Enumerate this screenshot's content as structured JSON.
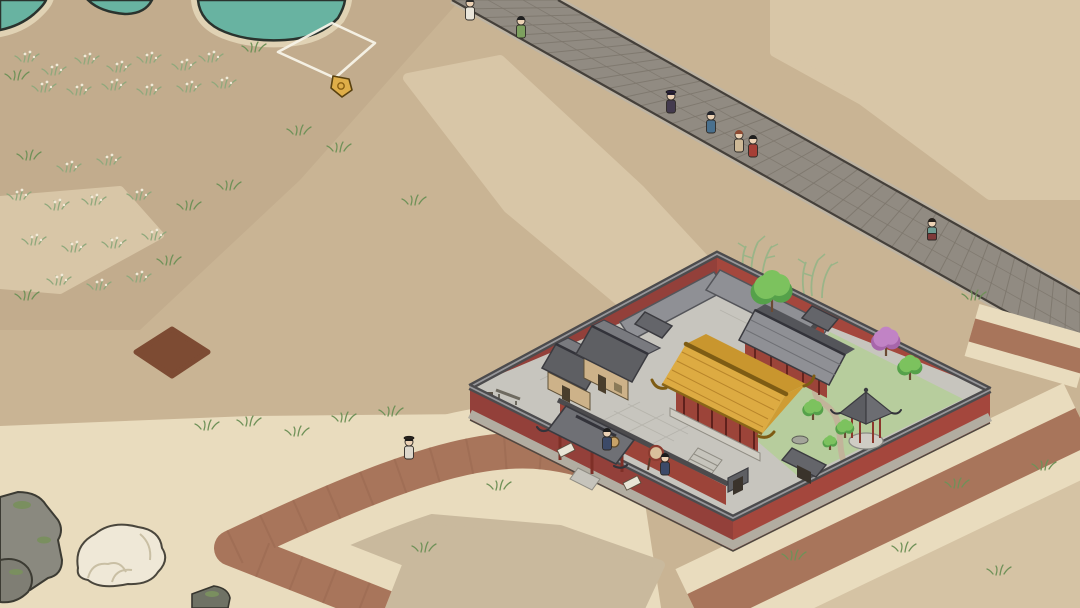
{
  "game": {
    "view": "isometric-town-overworld",
    "selection_tile": {
      "shape": "diamond-outline",
      "corners": [
        [
          332,
          23
        ],
        [
          375,
          43
        ],
        [
          335,
          78
        ],
        [
          278,
          52
        ]
      ],
      "marker": {
        "name": "gold-tag-marker",
        "x": 341,
        "y": 86
      }
    },
    "compound": {
      "type": "walled-temple-courtyard",
      "features": [
        "red-perimeter-wall",
        "golden-main-hall",
        "wooden-houses",
        "entrance-gate",
        "drum",
        "garden",
        "gazebo",
        "winding-path",
        "inner-gates"
      ]
    }
  },
  "palette": {
    "sand_base": "#c9b494",
    "sand_dark": "#c2ac8d",
    "sand_light": "#d8c6a7",
    "sand_cream": "#e9dcbe",
    "sand_gray": "#c9b99d",
    "soil_dark": "#7d4b33",
    "pond_teal": "#68b3a1",
    "pond_outline": "#2a332e",
    "shore": "#e0d2b4",
    "road_fill": "#918b82",
    "road_edge_dark": "#45403a",
    "road_curb": "#beb4a3",
    "road_slat": "#7d766c",
    "dirt_path": "#a8755b",
    "wall_red": "#9c4439",
    "wall_red_light": "#a4473d",
    "wall_red_dark": "#93403a",
    "coping": "#4c4b4d",
    "coping_light": "#97979a",
    "plinth": "#b2ada1",
    "paving": "#c7c5be",
    "paving_line": "#b0aea6",
    "roof_gray": "#64656a",
    "roof_gray_light": "#8f9095",
    "roof_gray_dark": "#54555a",
    "roof_gold": "#ddab42",
    "roof_gold_back": "#c9962e",
    "roof_gold_line": "#b8852a",
    "gold_trim": "#7e5c14",
    "wood_wall": "#cdb289",
    "wood_dark": "#5f5138",
    "lawn": "#b7cd9d",
    "garden_path": "#c2b49a",
    "tree_green": "#7cc25e",
    "tree_green_dark": "#55a14a",
    "tree_pink": "#c183c5",
    "tree_pink_dark": "#a766ab",
    "bamboo": "#9ab488",
    "skin": "#ecd2b5",
    "marker_gold": "#dfae49",
    "selection_white": "#f7f3e8",
    "rock_gray": "#8a897f",
    "rock_white": "#efe8d7",
    "moss": "#7a8f5f"
  },
  "scene": {
    "people": [
      {
        "id": "walker-white-top",
        "x": 470,
        "y": 20,
        "robe": "#e9e5da",
        "hair": "#2b2b2b"
      },
      {
        "id": "walker-green",
        "x": 521,
        "y": 38,
        "robe": "#7da05e",
        "hair": "#1f1f1f"
      },
      {
        "id": "walker-dark-purple",
        "x": 671,
        "y": 113,
        "robe": "#433a4e",
        "hair": "#27203a",
        "hat": "#27203a"
      },
      {
        "id": "walker-blue",
        "x": 711,
        "y": 133,
        "robe": "#49708e",
        "hair": "#22242c"
      },
      {
        "id": "walker-beige",
        "x": 739,
        "y": 152,
        "robe": "#cdb896",
        "hair": "#8e4b33"
      },
      {
        "id": "walker-red",
        "x": 753,
        "y": 157,
        "robe": "#a63f36",
        "hair": "#1f1f1f"
      },
      {
        "id": "walker-teal-skirt",
        "x": 932,
        "y": 240,
        "robe": "#6e9c93",
        "skirt": "#7e3a3a",
        "hair": "#27211c"
      },
      {
        "id": "traveler-path",
        "x": 409,
        "y": 459,
        "robe": "#ddd7cb",
        "hair": "#1c1c1c",
        "hat": "#26221e"
      },
      {
        "id": "guard-gate",
        "x": 607,
        "y": 450,
        "robe": "#3c4a68",
        "hair": "#1c1c1c"
      },
      {
        "id": "guard-drum",
        "x": 665,
        "y": 475,
        "robe": "#3c4a68",
        "hair": "#1c1c1c"
      }
    ],
    "trees": [
      {
        "id": "courtyard-tree",
        "type": "green",
        "x": 772,
        "y": 312,
        "r": 20
      },
      {
        "id": "garden-pink-tree",
        "type": "pink",
        "x": 886,
        "y": 356,
        "r": 14
      },
      {
        "id": "garden-tree-1",
        "type": "green",
        "x": 910,
        "y": 380,
        "r": 12
      },
      {
        "id": "garden-tree-2",
        "type": "green",
        "x": 813,
        "y": 420,
        "r": 10
      },
      {
        "id": "garden-tree-3",
        "type": "green",
        "x": 845,
        "y": 438,
        "r": 9
      },
      {
        "id": "garden-tree-4",
        "type": "green",
        "x": 830,
        "y": 450,
        "r": 7
      }
    ],
    "grass": [
      {
        "x": 28,
        "y": 62,
        "v": "flower"
      },
      {
        "x": 55,
        "y": 75,
        "v": "flower"
      },
      {
        "x": 88,
        "y": 64,
        "v": "flower"
      },
      {
        "x": 120,
        "y": 72,
        "v": "flower"
      },
      {
        "x": 150,
        "y": 63,
        "v": "flower"
      },
      {
        "x": 185,
        "y": 70,
        "v": "flower"
      },
      {
        "x": 212,
        "y": 62,
        "v": "flower"
      },
      {
        "x": 45,
        "y": 92,
        "v": "flower"
      },
      {
        "x": 80,
        "y": 95,
        "v": "flower"
      },
      {
        "x": 115,
        "y": 90,
        "v": "flower"
      },
      {
        "x": 150,
        "y": 95,
        "v": "flower"
      },
      {
        "x": 190,
        "y": 92,
        "v": "flower"
      },
      {
        "x": 225,
        "y": 88,
        "v": "flower"
      },
      {
        "x": 18,
        "y": 80,
        "v": "sprig"
      },
      {
        "x": 255,
        "y": 52,
        "v": "sprig"
      },
      {
        "x": 30,
        "y": 160,
        "v": "sprig"
      },
      {
        "x": 70,
        "y": 172,
        "v": "flower"
      },
      {
        "x": 110,
        "y": 165,
        "v": "flower"
      },
      {
        "x": 20,
        "y": 200,
        "v": "flower"
      },
      {
        "x": 58,
        "y": 210,
        "v": "flower"
      },
      {
        "x": 95,
        "y": 205,
        "v": "flower"
      },
      {
        "x": 140,
        "y": 200,
        "v": "flower"
      },
      {
        "x": 35,
        "y": 245,
        "v": "flower"
      },
      {
        "x": 75,
        "y": 252,
        "v": "flower"
      },
      {
        "x": 115,
        "y": 248,
        "v": "flower"
      },
      {
        "x": 155,
        "y": 240,
        "v": "flower"
      },
      {
        "x": 60,
        "y": 285,
        "v": "flower"
      },
      {
        "x": 100,
        "y": 290,
        "v": "flower"
      },
      {
        "x": 140,
        "y": 282,
        "v": "flower"
      },
      {
        "x": 28,
        "y": 300,
        "v": "sprig"
      },
      {
        "x": 170,
        "y": 265,
        "v": "sprig"
      },
      {
        "x": 190,
        "y": 210,
        "v": "sprig"
      },
      {
        "x": 230,
        "y": 190,
        "v": "sprig"
      },
      {
        "x": 300,
        "y": 135,
        "v": "sprig"
      },
      {
        "x": 340,
        "y": 152,
        "v": "sprig"
      },
      {
        "x": 415,
        "y": 205,
        "v": "sprig"
      },
      {
        "x": 208,
        "y": 430,
        "v": "sprig"
      },
      {
        "x": 250,
        "y": 426,
        "v": "sprig"
      },
      {
        "x": 298,
        "y": 436,
        "v": "sprig"
      },
      {
        "x": 345,
        "y": 422,
        "v": "sprig"
      },
      {
        "x": 392,
        "y": 416,
        "v": "sprig"
      },
      {
        "x": 500,
        "y": 490,
        "v": "sprig"
      },
      {
        "x": 425,
        "y": 552,
        "v": "sprig"
      },
      {
        "x": 612,
        "y": 470,
        "v": "sprig"
      },
      {
        "x": 660,
        "y": 492,
        "v": "sprig"
      },
      {
        "x": 748,
        "y": 540,
        "v": "sprig"
      },
      {
        "x": 795,
        "y": 560,
        "v": "sprig"
      },
      {
        "x": 905,
        "y": 552,
        "v": "sprig"
      },
      {
        "x": 1000,
        "y": 575,
        "v": "sprig"
      },
      {
        "x": 1045,
        "y": 470,
        "v": "sprig"
      },
      {
        "x": 958,
        "y": 488,
        "v": "sprig"
      },
      {
        "x": 920,
        "y": 452,
        "v": "sprig"
      },
      {
        "x": 975,
        "y": 300,
        "v": "sprig"
      }
    ]
  }
}
